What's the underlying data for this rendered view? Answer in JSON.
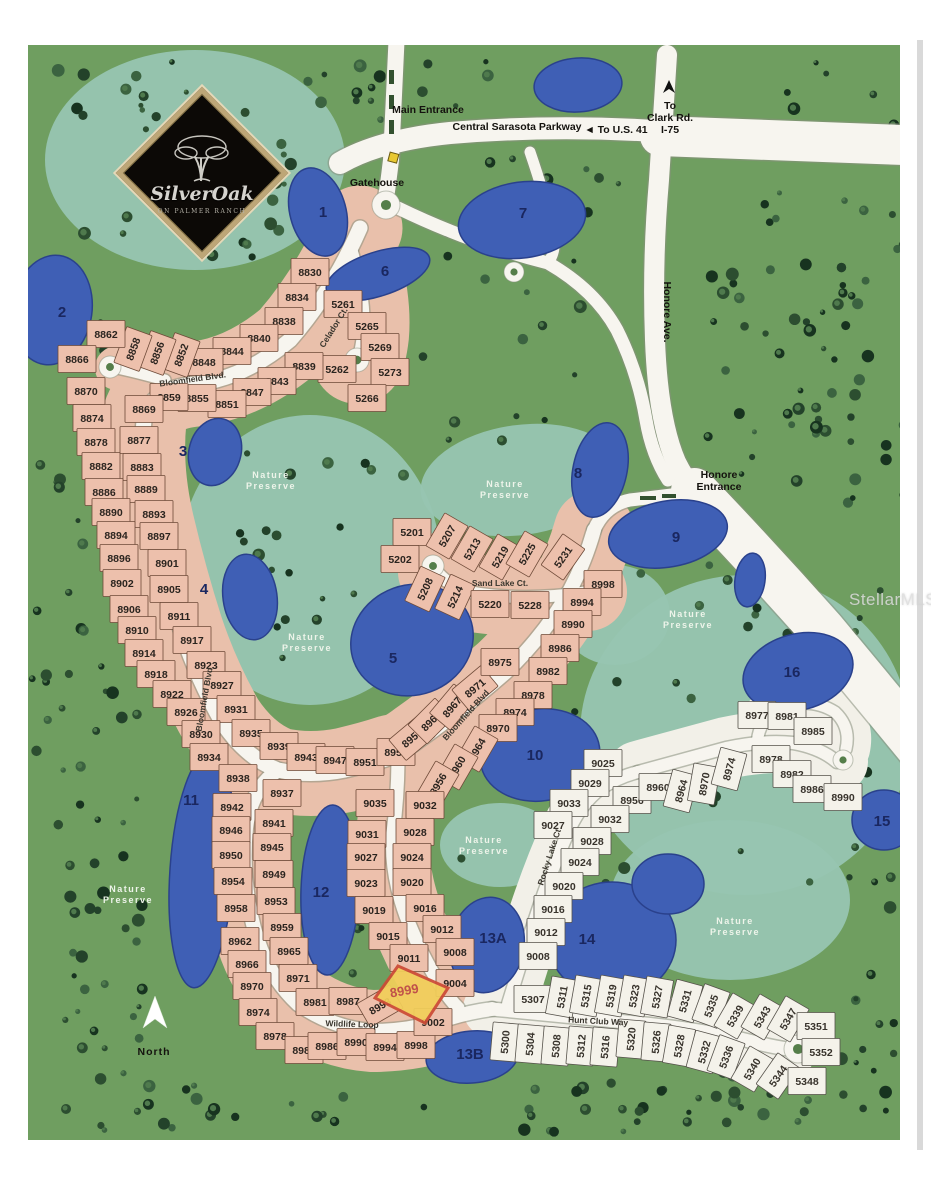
{
  "community": {
    "name": "Silver Oak",
    "subtitle": "ON PALMER RANCH"
  },
  "logo": {
    "title": "SilverOak",
    "subtitle": "ON PALMER RANCH"
  },
  "watermark": {
    "text": "StellarMLS"
  },
  "compass": {
    "label": "North"
  },
  "colors": {
    "grass": "#6f9e60",
    "preserve": "#97c5b1",
    "lake": "#3f5fb5",
    "lake_edge": "#2a418c",
    "road": "#f7f5ef",
    "road_edge": "#88907e",
    "lot_pink": "#edc0ac",
    "lot_pink_edge": "#6e4a38",
    "lot_white": "#f4f2ea",
    "lot_white_edge": "#55514a",
    "highlight_fill": "#f2cf5a",
    "highlight_edge": "#cc4b35"
  },
  "labels": [
    {
      "text": "Main Entrance",
      "x": 428,
      "y": 113,
      "fs": 10.5
    },
    {
      "text": "Central Sarasota Parkway",
      "x": 517,
      "y": 130,
      "fs": 11
    },
    {
      "text": "◄ To U.S. 41",
      "x": 616,
      "y": 133,
      "fs": 11
    },
    {
      "text": "To",
      "x": 670,
      "y": 109,
      "fs": 10
    },
    {
      "text": "Clark Rd.",
      "x": 670,
      "y": 121,
      "fs": 10
    },
    {
      "text": "I-75",
      "x": 670,
      "y": 133,
      "fs": 10
    },
    {
      "text": "Gatehouse",
      "x": 377,
      "y": 186,
      "fs": 9.5
    },
    {
      "text": "Honore",
      "x": 719,
      "y": 478,
      "fs": 10
    },
    {
      "text": "Entrance",
      "x": 719,
      "y": 490,
      "fs": 10
    },
    {
      "text": "Honore Ave.",
      "x": 664,
      "y": 312,
      "fs": 10.5,
      "rot": 90
    },
    {
      "text": "North",
      "x": 154,
      "y": 1055,
      "fs": 21,
      "color": "#ffffff",
      "ls": 1
    }
  ],
  "streets": [
    {
      "name": "Bloomfield Blvd.",
      "x": 193,
      "y": 382,
      "rot": -8
    },
    {
      "name": "Bloomfield Blvd",
      "x": 207,
      "y": 700,
      "rot": -80
    },
    {
      "name": "Bloomfield Blvd",
      "x": 468,
      "y": 717,
      "rot": -48
    },
    {
      "name": "Celador Ct.",
      "x": 336,
      "y": 329,
      "rot": -58
    },
    {
      "name": "Sand Lake Ct.",
      "x": 500,
      "y": 586,
      "rot": 0
    },
    {
      "name": "Rocky Lake Ct",
      "x": 552,
      "y": 858,
      "rot": -72
    },
    {
      "name": "Wildlife Loop",
      "x": 352,
      "y": 1027,
      "rot": 2
    },
    {
      "name": "Hunt Club Way",
      "x": 598,
      "y": 1024,
      "rot": 3
    }
  ],
  "preserve_label": {
    "line1": "Nature",
    "line2": "Preserve"
  },
  "preserves": [
    {
      "x": 271,
      "y": 478
    },
    {
      "x": 505,
      "y": 487
    },
    {
      "x": 307,
      "y": 640
    },
    {
      "x": 688,
      "y": 617
    },
    {
      "x": 128,
      "y": 892
    },
    {
      "x": 484,
      "y": 843
    },
    {
      "x": 735,
      "y": 924
    }
  ],
  "tracts": [
    {
      "id": "1",
      "x": 323,
      "y": 217
    },
    {
      "id": "2",
      "x": 62,
      "y": 317
    },
    {
      "id": "3",
      "x": 183,
      "y": 456
    },
    {
      "id": "4",
      "x": 204,
      "y": 594
    },
    {
      "id": "5",
      "x": 393,
      "y": 663
    },
    {
      "id": "6",
      "x": 385,
      "y": 276
    },
    {
      "id": "7",
      "x": 523,
      "y": 218
    },
    {
      "id": "8",
      "x": 578,
      "y": 478
    },
    {
      "id": "9",
      "x": 676,
      "y": 542
    },
    {
      "id": "10",
      "x": 535,
      "y": 760
    },
    {
      "id": "11",
      "x": 191,
      "y": 805
    },
    {
      "id": "12",
      "x": 321,
      "y": 897
    },
    {
      "id": "13A",
      "x": 493,
      "y": 943
    },
    {
      "id": "13B",
      "x": 470,
      "y": 1059
    },
    {
      "id": "14",
      "x": 587,
      "y": 944
    },
    {
      "id": "15",
      "x": 882,
      "y": 826
    },
    {
      "id": "16",
      "x": 792,
      "y": 677
    }
  ],
  "highlight": {
    "lot": "8999",
    "label_x": 405,
    "label_y": 995,
    "label_rot": -10
  },
  "lots": [
    {
      "n": "8830",
      "x": 310,
      "y": 272
    },
    {
      "n": "8834",
      "x": 297,
      "y": 297
    },
    {
      "n": "8838",
      "x": 284,
      "y": 321
    },
    {
      "n": "8840",
      "x": 259,
      "y": 338
    },
    {
      "n": "8844",
      "x": 232,
      "y": 351
    },
    {
      "n": "8848",
      "x": 204,
      "y": 362
    },
    {
      "n": "8852",
      "x": 181,
      "y": 355,
      "r": -70
    },
    {
      "n": "8856",
      "x": 157,
      "y": 353,
      "r": -70
    },
    {
      "n": "8858",
      "x": 133,
      "y": 349,
      "r": -70
    },
    {
      "n": "8862",
      "x": 106,
      "y": 334
    },
    {
      "n": "8866",
      "x": 77,
      "y": 359
    },
    {
      "n": "8870",
      "x": 86,
      "y": 391
    },
    {
      "n": "8874",
      "x": 92,
      "y": 418
    },
    {
      "n": "5261",
      "x": 343,
      "y": 304
    },
    {
      "n": "5265",
      "x": 367,
      "y": 326
    },
    {
      "n": "5269",
      "x": 380,
      "y": 347
    },
    {
      "n": "5273",
      "x": 390,
      "y": 372
    },
    {
      "n": "5262",
      "x": 337,
      "y": 369
    },
    {
      "n": "5266",
      "x": 367,
      "y": 398
    },
    {
      "n": "8839",
      "x": 304,
      "y": 366
    },
    {
      "n": "8843",
      "x": 277,
      "y": 381
    },
    {
      "n": "8847",
      "x": 252,
      "y": 392
    },
    {
      "n": "8851",
      "x": 227,
      "y": 404
    },
    {
      "n": "8855",
      "x": 197,
      "y": 398
    },
    {
      "n": "8859",
      "x": 169,
      "y": 397
    },
    {
      "n": "8869",
      "x": 144,
      "y": 409
    },
    {
      "n": "8877",
      "x": 139,
      "y": 440
    },
    {
      "n": "8878",
      "x": 96,
      "y": 442
    },
    {
      "n": "8882",
      "x": 101,
      "y": 466
    },
    {
      "n": "8883",
      "x": 142,
      "y": 467
    },
    {
      "n": "8886",
      "x": 104,
      "y": 492
    },
    {
      "n": "8889",
      "x": 146,
      "y": 489
    },
    {
      "n": "8890",
      "x": 111,
      "y": 512
    },
    {
      "n": "8893",
      "x": 154,
      "y": 514
    },
    {
      "n": "8894",
      "x": 116,
      "y": 535
    },
    {
      "n": "8897",
      "x": 159,
      "y": 536
    },
    {
      "n": "8896",
      "x": 119,
      "y": 558
    },
    {
      "n": "8901",
      "x": 167,
      "y": 563
    },
    {
      "n": "8902",
      "x": 122,
      "y": 583
    },
    {
      "n": "8905",
      "x": 169,
      "y": 589
    },
    {
      "n": "8906",
      "x": 129,
      "y": 609
    },
    {
      "n": "8911",
      "x": 179,
      "y": 616
    },
    {
      "n": "8910",
      "x": 137,
      "y": 630
    },
    {
      "n": "8917",
      "x": 192,
      "y": 640
    },
    {
      "n": "8914",
      "x": 144,
      "y": 653
    },
    {
      "n": "8923",
      "x": 206,
      "y": 665
    },
    {
      "n": "8918",
      "x": 156,
      "y": 674
    },
    {
      "n": "8927",
      "x": 222,
      "y": 685
    },
    {
      "n": "8922",
      "x": 172,
      "y": 694
    },
    {
      "n": "8931",
      "x": 236,
      "y": 709
    },
    {
      "n": "8926",
      "x": 186,
      "y": 712
    },
    {
      "n": "8930",
      "x": 201,
      "y": 734
    },
    {
      "n": "8935",
      "x": 251,
      "y": 733
    },
    {
      "n": "8934",
      "x": 209,
      "y": 757
    },
    {
      "n": "8938",
      "x": 238,
      "y": 778
    },
    {
      "n": "8939",
      "x": 279,
      "y": 746
    },
    {
      "n": "8943",
      "x": 306,
      "y": 757
    },
    {
      "n": "8947",
      "x": 335,
      "y": 760
    },
    {
      "n": "8951",
      "x": 365,
      "y": 762
    },
    {
      "n": "8955",
      "x": 396,
      "y": 752
    },
    {
      "n": "8959",
      "x": 412,
      "y": 738,
      "r": -40
    },
    {
      "n": "8963",
      "x": 431,
      "y": 721,
      "r": -45
    },
    {
      "n": "8967",
      "x": 452,
      "y": 707,
      "r": -50
    },
    {
      "n": "8971",
      "x": 475,
      "y": 688,
      "r": -40
    },
    {
      "n": "8975",
      "x": 500,
      "y": 662
    },
    {
      "n": "8998",
      "x": 603,
      "y": 584
    },
    {
      "n": "8994",
      "x": 582,
      "y": 602
    },
    {
      "n": "8990",
      "x": 573,
      "y": 624
    },
    {
      "n": "8986",
      "x": 560,
      "y": 648
    },
    {
      "n": "8982",
      "x": 548,
      "y": 671
    },
    {
      "n": "8978",
      "x": 533,
      "y": 695
    },
    {
      "n": "8974",
      "x": 515,
      "y": 712
    },
    {
      "n": "8970",
      "x": 498,
      "y": 728
    },
    {
      "n": "8964",
      "x": 477,
      "y": 749,
      "r": -60
    },
    {
      "n": "8960",
      "x": 457,
      "y": 767,
      "r": -60
    },
    {
      "n": "8956",
      "x": 438,
      "y": 784,
      "r": -60
    },
    {
      "n": "5201",
      "x": 412,
      "y": 532
    },
    {
      "n": "5202",
      "x": 400,
      "y": 559
    },
    {
      "n": "5207",
      "x": 447,
      "y": 536,
      "r": -60
    },
    {
      "n": "5213",
      "x": 472,
      "y": 549,
      "r": -60
    },
    {
      "n": "5219",
      "x": 500,
      "y": 557,
      "r": -60
    },
    {
      "n": "5225",
      "x": 527,
      "y": 554,
      "r": -60
    },
    {
      "n": "5231",
      "x": 563,
      "y": 557,
      "r": -55
    },
    {
      "n": "5208",
      "x": 425,
      "y": 589,
      "r": -65
    },
    {
      "n": "5214",
      "x": 455,
      "y": 597,
      "r": -65
    },
    {
      "n": "5220",
      "x": 490,
      "y": 604
    },
    {
      "n": "5228",
      "x": 530,
      "y": 605
    },
    {
      "n": "8937",
      "x": 282,
      "y": 793
    },
    {
      "n": "8941",
      "x": 274,
      "y": 823
    },
    {
      "n": "8945",
      "x": 272,
      "y": 847
    },
    {
      "n": "8949",
      "x": 274,
      "y": 874
    },
    {
      "n": "8953",
      "x": 276,
      "y": 901
    },
    {
      "n": "8959",
      "x": 282,
      "y": 927
    },
    {
      "n": "8965",
      "x": 289,
      "y": 951
    },
    {
      "n": "8971",
      "x": 298,
      "y": 978
    },
    {
      "n": "8942",
      "x": 232,
      "y": 807
    },
    {
      "n": "8946",
      "x": 231,
      "y": 830
    },
    {
      "n": "8950",
      "x": 231,
      "y": 855
    },
    {
      "n": "8954",
      "x": 233,
      "y": 881
    },
    {
      "n": "8958",
      "x": 236,
      "y": 908
    },
    {
      "n": "8962",
      "x": 240,
      "y": 941
    },
    {
      "n": "8966",
      "x": 247,
      "y": 964
    },
    {
      "n": "8970",
      "x": 252,
      "y": 986
    },
    {
      "n": "9035",
      "x": 375,
      "y": 803
    },
    {
      "n": "9031",
      "x": 367,
      "y": 834
    },
    {
      "n": "9027",
      "x": 366,
      "y": 857
    },
    {
      "n": "9023",
      "x": 366,
      "y": 883
    },
    {
      "n": "9019",
      "x": 374,
      "y": 910
    },
    {
      "n": "9015",
      "x": 388,
      "y": 936
    },
    {
      "n": "9011",
      "x": 409,
      "y": 958
    },
    {
      "n": "9032",
      "x": 425,
      "y": 805
    },
    {
      "n": "9028",
      "x": 415,
      "y": 832
    },
    {
      "n": "9024",
      "x": 412,
      "y": 857
    },
    {
      "n": "9020",
      "x": 412,
      "y": 882
    },
    {
      "n": "9016",
      "x": 425,
      "y": 908
    },
    {
      "n": "9012",
      "x": 442,
      "y": 929
    },
    {
      "n": "9008",
      "x": 455,
      "y": 952
    },
    {
      "n": "9004",
      "x": 455,
      "y": 983
    },
    {
      "n": "8974",
      "x": 258,
      "y": 1012
    },
    {
      "n": "8978",
      "x": 275,
      "y": 1036
    },
    {
      "n": "8981",
      "x": 315,
      "y": 1002
    },
    {
      "n": "8987",
      "x": 348,
      "y": 1001
    },
    {
      "n": "8993",
      "x": 380,
      "y": 1006,
      "r": -30
    },
    {
      "n": "8982",
      "x": 304,
      "y": 1050
    },
    {
      "n": "8986",
      "x": 327,
      "y": 1046
    },
    {
      "n": "8990",
      "x": 356,
      "y": 1042
    },
    {
      "n": "8994",
      "x": 385,
      "y": 1047
    },
    {
      "n": "8998",
      "x": 416,
      "y": 1045
    },
    {
      "n": "9002",
      "x": 433,
      "y": 1022
    },
    {
      "n": "8999",
      "x": 405,
      "y": 990,
      "r": -20,
      "c": "h"
    },
    {
      "n": "9025",
      "x": 603,
      "y": 763,
      "c": "w"
    },
    {
      "n": "9029",
      "x": 590,
      "y": 783,
      "c": "w"
    },
    {
      "n": "9033",
      "x": 569,
      "y": 803,
      "c": "w"
    },
    {
      "n": "9027",
      "x": 553,
      "y": 825,
      "c": "w"
    },
    {
      "n": "8956",
      "x": 632,
      "y": 800,
      "c": "w"
    },
    {
      "n": "8960",
      "x": 658,
      "y": 787,
      "c": "w"
    },
    {
      "n": "8964",
      "x": 681,
      "y": 791,
      "r": -75,
      "c": "w"
    },
    {
      "n": "8970",
      "x": 704,
      "y": 784,
      "r": -80,
      "c": "w"
    },
    {
      "n": "8974",
      "x": 729,
      "y": 769,
      "r": -75,
      "c": "w"
    },
    {
      "n": "8978",
      "x": 771,
      "y": 759,
      "c": "w"
    },
    {
      "n": "8982",
      "x": 792,
      "y": 774,
      "c": "w"
    },
    {
      "n": "8986",
      "x": 812,
      "y": 789,
      "c": "w"
    },
    {
      "n": "8990",
      "x": 843,
      "y": 797,
      "c": "w"
    },
    {
      "n": "8977",
      "x": 757,
      "y": 715,
      "c": "w"
    },
    {
      "n": "8981",
      "x": 787,
      "y": 716,
      "c": "w"
    },
    {
      "n": "8985",
      "x": 813,
      "y": 731,
      "c": "w"
    },
    {
      "n": "9032",
      "x": 610,
      "y": 819,
      "c": "w"
    },
    {
      "n": "9028",
      "x": 592,
      "y": 841,
      "c": "w"
    },
    {
      "n": "9024",
      "x": 580,
      "y": 862,
      "c": "w"
    },
    {
      "n": "9020",
      "x": 564,
      "y": 886,
      "c": "w"
    },
    {
      "n": "9016",
      "x": 553,
      "y": 909,
      "c": "w"
    },
    {
      "n": "9012",
      "x": 546,
      "y": 932,
      "c": "w"
    },
    {
      "n": "9008",
      "x": 538,
      "y": 956,
      "c": "w"
    },
    {
      "n": "5307",
      "x": 533,
      "y": 999,
      "c": "w"
    },
    {
      "n": "5311",
      "x": 562,
      "y": 997,
      "r": -80,
      "c": "w"
    },
    {
      "n": "5315",
      "x": 586,
      "y": 996,
      "r": -80,
      "c": "w"
    },
    {
      "n": "5319",
      "x": 611,
      "y": 996,
      "r": -80,
      "c": "w"
    },
    {
      "n": "5323",
      "x": 634,
      "y": 996,
      "r": -80,
      "c": "w"
    },
    {
      "n": "5327",
      "x": 657,
      "y": 997,
      "r": -80,
      "c": "w"
    },
    {
      "n": "5331",
      "x": 685,
      "y": 1001,
      "r": -75,
      "c": "w"
    },
    {
      "n": "5335",
      "x": 711,
      "y": 1006,
      "r": -70,
      "c": "w"
    },
    {
      "n": "5339",
      "x": 735,
      "y": 1016,
      "r": -60,
      "c": "w"
    },
    {
      "n": "5343",
      "x": 762,
      "y": 1017,
      "r": -60,
      "c": "w"
    },
    {
      "n": "5347",
      "x": 788,
      "y": 1019,
      "r": -60,
      "c": "w"
    },
    {
      "n": "5351",
      "x": 816,
      "y": 1026,
      "c": "w"
    },
    {
      "n": "5300",
      "x": 505,
      "y": 1042,
      "r": -85,
      "c": "w"
    },
    {
      "n": "5304",
      "x": 530,
      "y": 1044,
      "r": -85,
      "c": "w"
    },
    {
      "n": "5308",
      "x": 556,
      "y": 1046,
      "r": -85,
      "c": "w"
    },
    {
      "n": "5312",
      "x": 581,
      "y": 1046,
      "r": -85,
      "c": "w"
    },
    {
      "n": "5316",
      "x": 605,
      "y": 1047,
      "r": -85,
      "c": "w"
    },
    {
      "n": "5320",
      "x": 631,
      "y": 1039,
      "r": -85,
      "c": "w"
    },
    {
      "n": "5326",
      "x": 656,
      "y": 1042,
      "r": -85,
      "c": "w"
    },
    {
      "n": "5328",
      "x": 679,
      "y": 1046,
      "r": -80,
      "c": "w"
    },
    {
      "n": "5332",
      "x": 704,
      "y": 1052,
      "r": -75,
      "c": "w"
    },
    {
      "n": "5336",
      "x": 726,
      "y": 1057,
      "r": -70,
      "c": "w"
    },
    {
      "n": "5340",
      "x": 752,
      "y": 1069,
      "r": -60,
      "c": "w"
    },
    {
      "n": "5344",
      "x": 778,
      "y": 1076,
      "r": -55,
      "c": "w"
    },
    {
      "n": "5348",
      "x": 807,
      "y": 1081,
      "c": "w"
    },
    {
      "n": "5352",
      "x": 821,
      "y": 1052,
      "c": "w"
    }
  ]
}
